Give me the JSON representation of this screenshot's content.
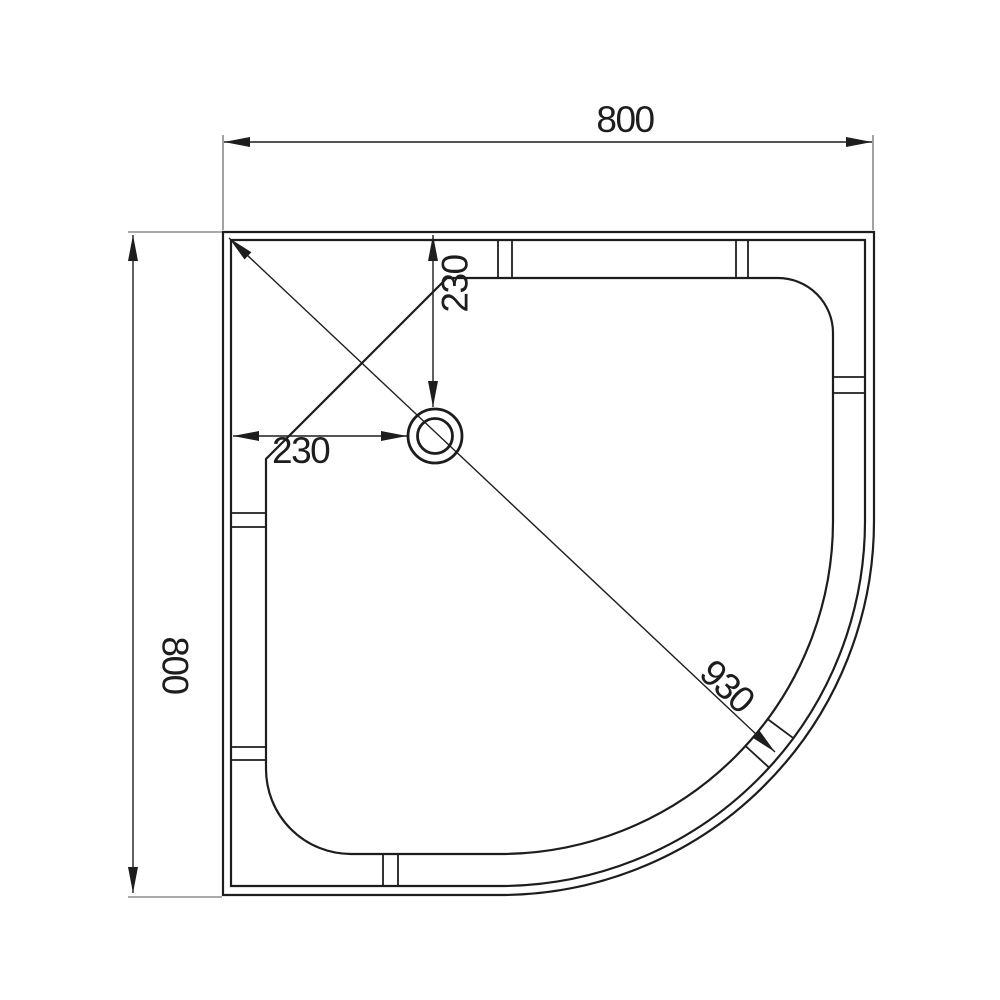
{
  "drawing": {
    "background": "#ffffff",
    "line_color": "#1d1d1d",
    "dims": {
      "width_top": "800",
      "height_left": "800",
      "drain_from_left": "230",
      "drain_from_top": "230",
      "diagonal": "930"
    }
  }
}
